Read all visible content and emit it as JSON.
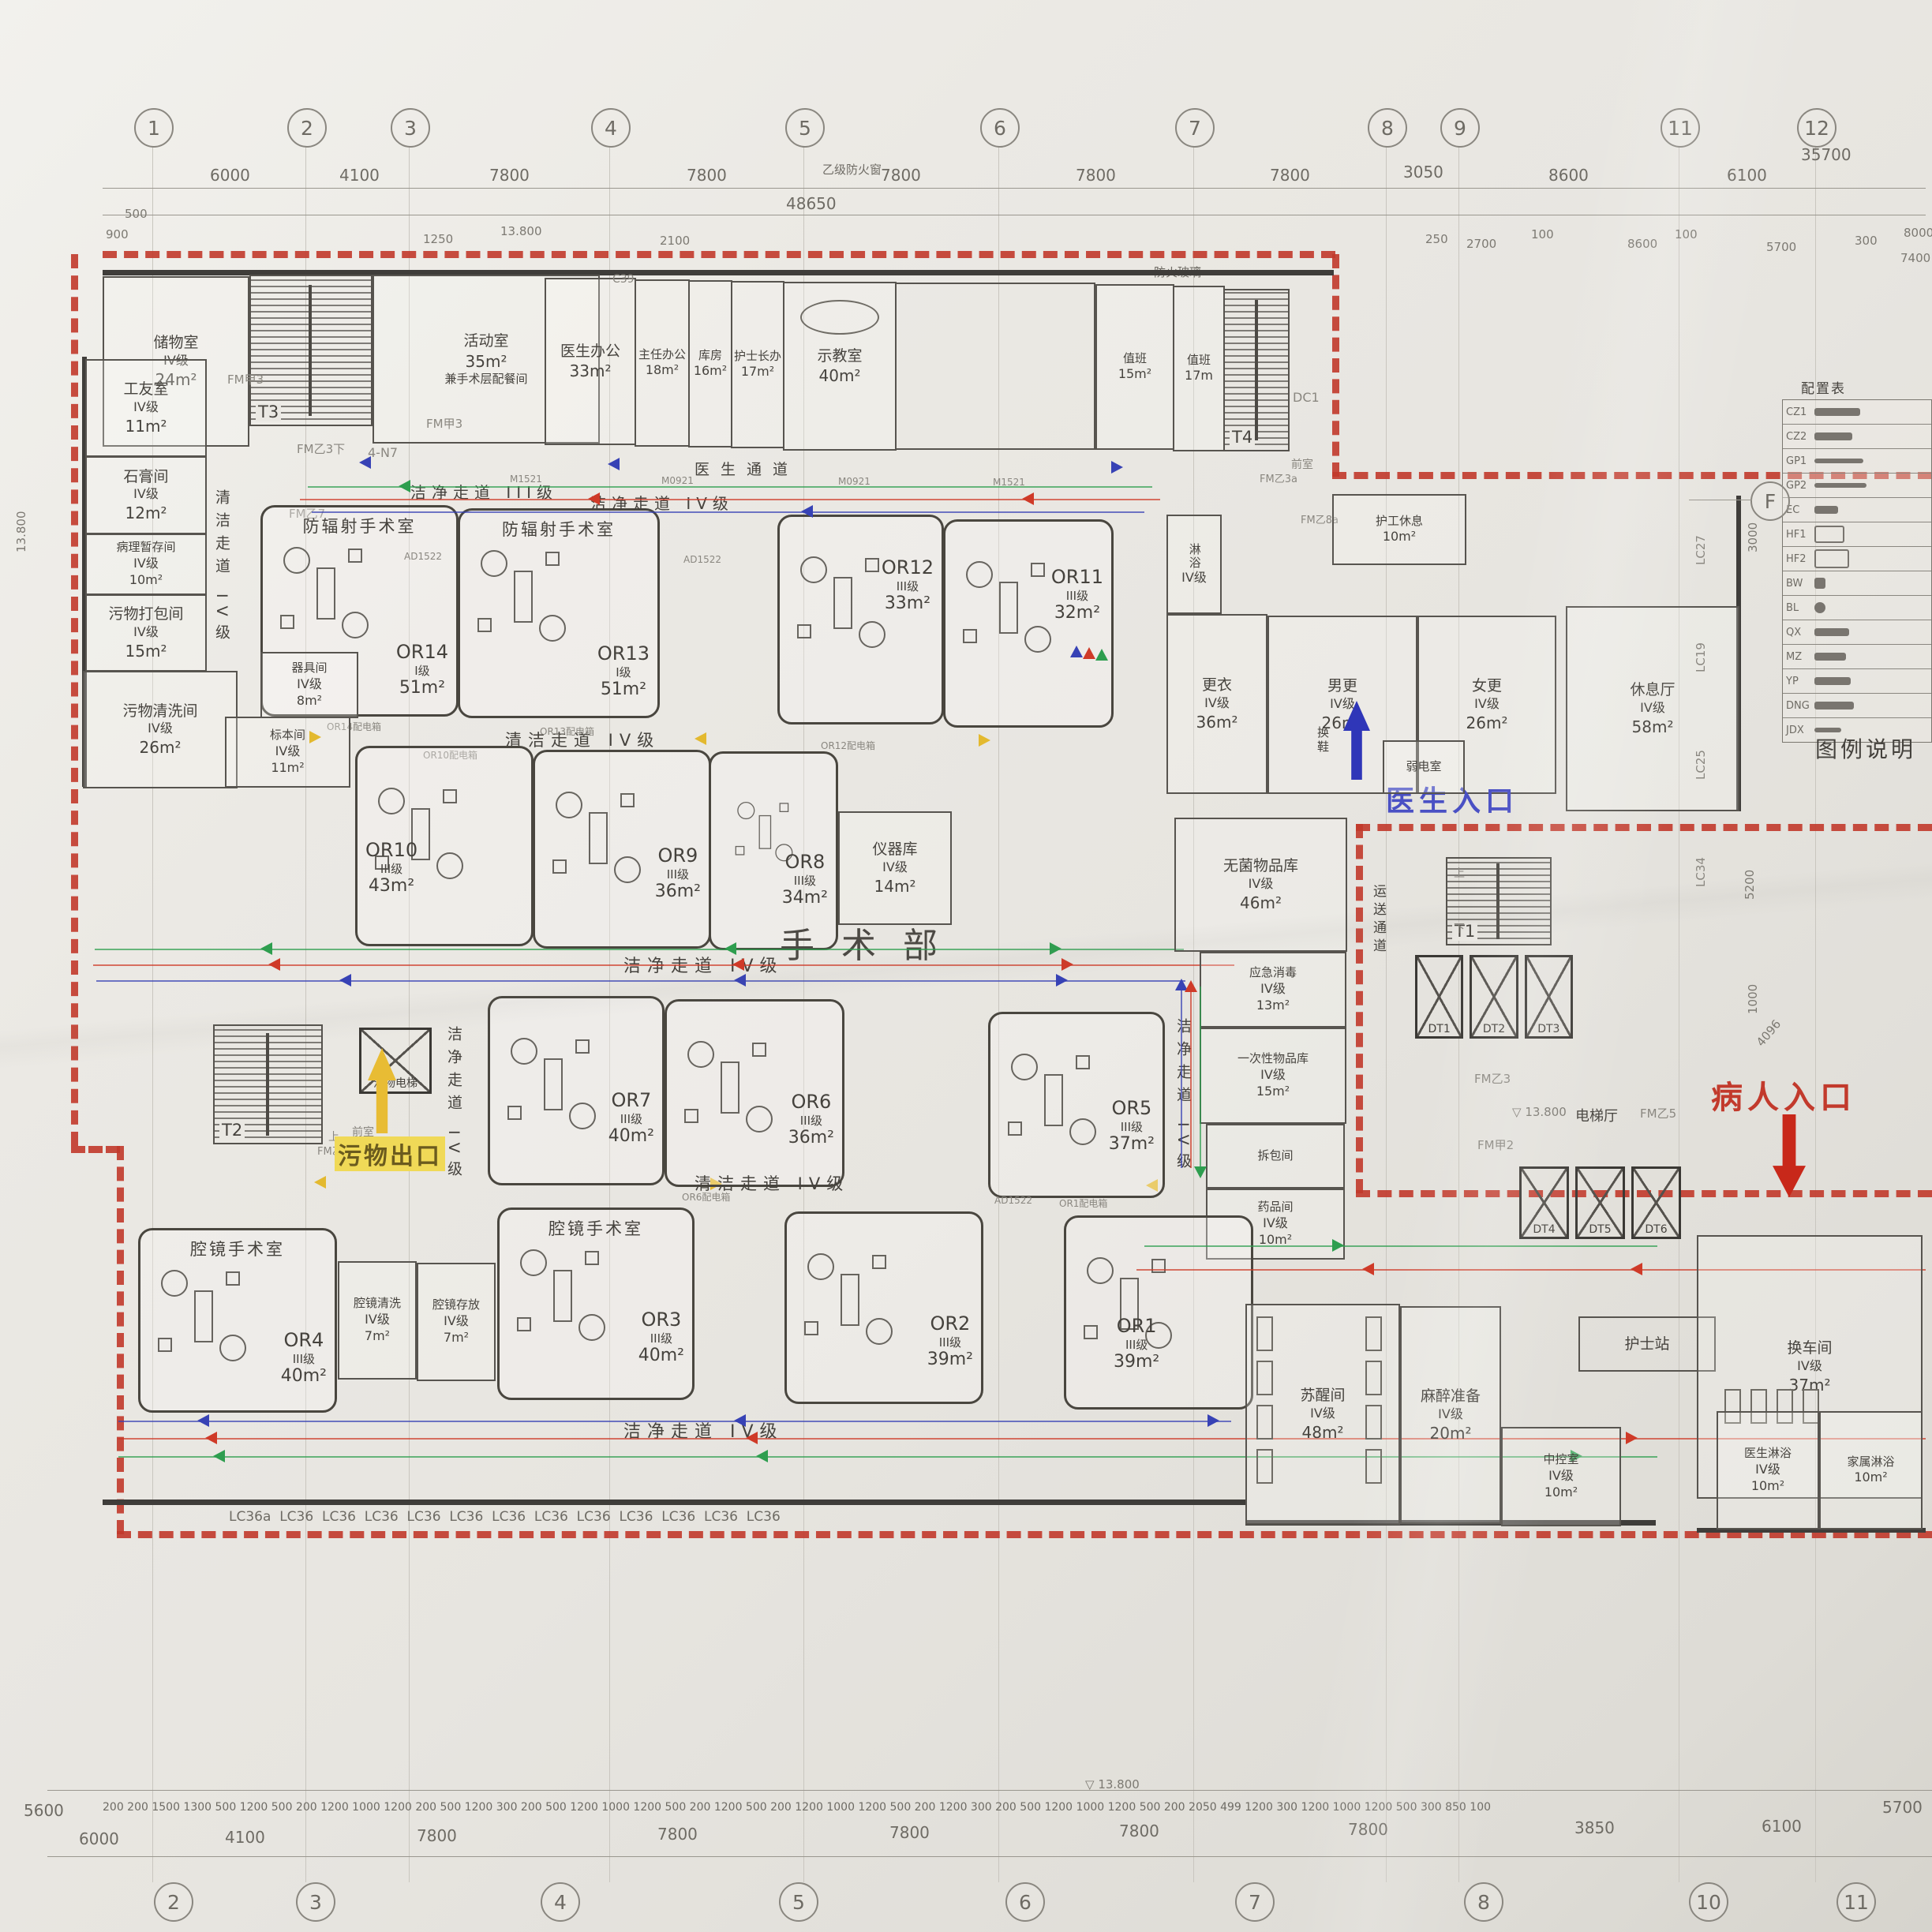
{
  "sheet": {
    "dept_label": "手术部",
    "legend_caption": "图例说明",
    "config_table_title": "配置表",
    "level": "13.800",
    "notes": {
      "fire_window": "乙级防火窗",
      "fire_glass": "防火玻璃"
    }
  },
  "grid": {
    "top_bubbles": [
      "1",
      "2",
      "3",
      "4",
      "5",
      "6",
      "7",
      "8",
      "9",
      "11",
      "12"
    ],
    "bottom_bubbles": [
      "2",
      "3",
      "4",
      "5",
      "6",
      "7",
      "8",
      "10",
      "11"
    ],
    "side_bubble": "F",
    "top_dims": [
      "6000",
      "4100",
      "7800",
      "7800",
      "7800",
      "7800",
      "7800",
      "3050",
      "8600",
      "6100"
    ],
    "top_overall": "48650",
    "top_right_overall": "35700",
    "sub": {
      "a": "900",
      "b": "500",
      "c": "1250",
      "d": "13.800",
      "e": "250",
      "f": "2700",
      "g": "100",
      "h": "8600",
      "i": "100",
      "j": "5700",
      "k": "300",
      "l": "8000",
      "m": "7400",
      "n": "2100"
    },
    "bottom_dims": [
      "6000",
      "4100",
      "7800",
      "7800",
      "7800",
      "7800",
      "7800",
      "3850",
      "6100"
    ],
    "bottom_left": "5600",
    "bottom_right": "5700",
    "bottom_level": "13.800",
    "bottom_small": [
      "200",
      "200",
      "1500",
      "1300",
      "500",
      "1200",
      "500",
      "200",
      "1200",
      "1000",
      "1200",
      "200",
      "500",
      "1200",
      "300",
      "200",
      "500",
      "1200",
      "1000",
      "1200",
      "500",
      "200",
      "1200",
      "500",
      "200",
      "1200",
      "1000",
      "1200",
      "500",
      "200",
      "1200",
      "300",
      "200",
      "500",
      "1200",
      "1000",
      "1200",
      "500",
      "200",
      "2050",
      "499",
      "1200",
      "300",
      "1200",
      "1000",
      "1200",
      "500",
      "300",
      "850",
      "100"
    ],
    "right_dims": {
      "a": "3000",
      "b": "5200",
      "c": "1000",
      "d": "4096"
    },
    "left_dim": "13.800"
  },
  "entrances": {
    "doctor": "医生入口",
    "patient": "病人入口",
    "waste": "污物出口"
  },
  "corridors": {
    "clean3": "洁净走道 III级",
    "clean4": "洁净走道 IV级",
    "cleaning4": "清洁走道 IV级",
    "doctor": "医生通道",
    "transport": "运送通道",
    "anteroom": "前室",
    "shoe": "换鞋"
  },
  "labels": {
    "radiation_or": "防辐射手术室",
    "endoscope_or": "腔镜手术室",
    "waste_lift": "污物电梯",
    "lift_hall": "电梯厅"
  },
  "ors": {
    "or1": {
      "code": "OR1",
      "grade": "III级",
      "area": "39m²"
    },
    "or2": {
      "code": "OR2",
      "grade": "III级",
      "area": "39m²"
    },
    "or3": {
      "code": "OR3",
      "grade": "III级",
      "area": "40m²"
    },
    "or4": {
      "code": "OR4",
      "grade": "III级",
      "area": "40m²"
    },
    "or5": {
      "code": "OR5",
      "grade": "III级",
      "area": "37m²"
    },
    "or6": {
      "code": "OR6",
      "grade": "III级",
      "area": "36m²"
    },
    "or7": {
      "code": "OR7",
      "grade": "III级",
      "area": "40m²"
    },
    "or8": {
      "code": "OR8",
      "grade": "III级",
      "area": "34m²"
    },
    "or9": {
      "code": "OR9",
      "grade": "III级",
      "area": "36m²"
    },
    "or10": {
      "code": "OR10",
      "grade": "III级",
      "area": "43m²"
    },
    "or11": {
      "code": "OR11",
      "grade": "III级",
      "area": "32m²"
    },
    "or12": {
      "code": "OR12",
      "grade": "III级",
      "area": "33m²"
    },
    "or13": {
      "code": "OR13",
      "grade": "I级",
      "area": "51m²"
    },
    "or14": {
      "code": "OR14",
      "grade": "I级",
      "area": "51m²"
    }
  },
  "rooms": {
    "storage24": {
      "name": "储物室",
      "grade": "IV级",
      "area": "24m²"
    },
    "activity": {
      "name": "活动室",
      "grade": "",
      "area": "35m²",
      "sub": "兼手术层配餐间"
    },
    "doc_office": {
      "name": "医生办公",
      "grade": "",
      "area": "33m²"
    },
    "chief_office": {
      "name": "主任办公",
      "grade": "",
      "area": "18m²"
    },
    "storeroom": {
      "name": "库房",
      "grade": "",
      "area": "16m²"
    },
    "head_nurse": {
      "name": "护士长办",
      "grade": "",
      "area": "17m²"
    },
    "demo": {
      "name": "示教室",
      "grade": "",
      "area": "40m²"
    },
    "duty15": {
      "name": "值班",
      "grade": "",
      "area": "15m²"
    },
    "duty17": {
      "name": "值班",
      "grade": "",
      "area": "17m"
    },
    "porter": {
      "name": "护工休息",
      "grade": "",
      "area": "10m²"
    },
    "worker": {
      "name": "工友室",
      "grade": "IV级",
      "area": "11m²"
    },
    "plaster": {
      "name": "石膏间",
      "grade": "IV级",
      "area": "12m²"
    },
    "pathology": {
      "name": "病理暂存间",
      "grade": "IV级",
      "area": "10m²"
    },
    "waste_pack": {
      "name": "污物打包间",
      "grade": "IV级",
      "area": "15m²"
    },
    "waste_wash": {
      "name": "污物清洗间",
      "grade": "IV级",
      "area": "26m²"
    },
    "utensil": {
      "name": "器具间",
      "grade": "IV级",
      "area": "8m²"
    },
    "specimen": {
      "name": "标本间",
      "grade": "IV级",
      "area": "11m²"
    },
    "instrument": {
      "name": "仪器库",
      "grade": "IV级",
      "area": "14m²"
    },
    "sterile": {
      "name": "无菌物品库",
      "grade": "IV级",
      "area": "46m²"
    },
    "emerg": {
      "name": "应急消毒",
      "grade": "IV级",
      "area": "13m²"
    },
    "disposable": {
      "name": "一次性物品库",
      "grade": "IV级",
      "area": "15m²"
    },
    "unpack": {
      "name": "拆包间",
      "grade": "",
      "area": ""
    },
    "medicine": {
      "name": "药品间",
      "grade": "IV级",
      "area": "10m²"
    },
    "shower": {
      "name": "淋浴",
      "grade": "IV级",
      "area": ""
    },
    "changing": {
      "name": "更衣",
      "grade": "IV级",
      "area": "36m²"
    },
    "male_change": {
      "name": "男更",
      "grade": "IV级",
      "area": "26m²"
    },
    "female_change": {
      "name": "女更",
      "grade": "IV级",
      "area": "26m²"
    },
    "lounge": {
      "name": "休息厅",
      "grade": "IV级",
      "area": "58m²"
    },
    "endo_wash": {
      "name": "腔镜清洗",
      "grade": "IV级",
      "area": "7m²"
    },
    "endo_store": {
      "name": "腔镜存放",
      "grade": "IV级",
      "area": "7m²"
    },
    "recovery": {
      "name": "苏醒间",
      "grade": "IV级",
      "area": "48m²"
    },
    "anesthesia": {
      "name": "麻醉准备",
      "grade": "IV级",
      "area": "20m²"
    },
    "nurse_station": {
      "name": "护士站",
      "grade": "",
      "area": ""
    },
    "control": {
      "name": "中控室",
      "grade": "IV级",
      "area": "10m²"
    },
    "bed_change": {
      "name": "换车间",
      "grade": "IV级",
      "area": "37m²"
    },
    "doc_shower": {
      "name": "医生淋浴",
      "grade": "IV级",
      "area": "10m²"
    },
    "family_shower": {
      "name": "家属淋浴",
      "grade": "",
      "area": "10m²"
    },
    "weak_power": {
      "name": "弱电室",
      "grade": "",
      "area": ""
    }
  },
  "stairs": {
    "t1": "T1",
    "t2": "T2",
    "t3": "T3",
    "t4": "T4",
    "up": "上",
    "down": "下"
  },
  "lifts": {
    "service": [
      "DT1",
      "DT2",
      "DT3"
    ],
    "patient": [
      "DT4",
      "DT5",
      "DT6"
    ]
  },
  "doors": {
    "fmj2": "FM甲2",
    "fmj3": "FM甲3",
    "fmy3": "FM乙3",
    "fmy3x": "FM乙3下",
    "fmy3a": "FM乙3a",
    "fmy5": "FM乙5",
    "fmy7": "FM乙7",
    "fmy8a": "FM乙8a",
    "dc1": "DC1",
    "n7": "4-N7",
    "c39": "C39"
  },
  "windows": {
    "bottom_row": [
      "LC36a",
      "LC36",
      "LC36",
      "LC36",
      "LC36",
      "LC36",
      "LC36",
      "LC36",
      "LC36",
      "LC36",
      "LC36",
      "LC36",
      "LC36"
    ],
    "right": {
      "a": "LC27",
      "b": "LC19",
      "c": "LC25",
      "d": "LC34"
    }
  },
  "equip_codes": {
    "ad": "AD1522",
    "m1": "M1521",
    "m2": "M0921",
    "db14": "OR14配电箱",
    "db13": "OR13配电箱",
    "db10": "OR10配电箱",
    "db12": "OR12配电箱",
    "db6": "OR6配电箱",
    "db1": "OR1配电箱"
  },
  "legend_codes": [
    "CZ1",
    "CZ2",
    "GP1",
    "GP2",
    "EC",
    "HF1",
    "HF2",
    "BW",
    "BL",
    "QX",
    "MZ",
    "YP",
    "DNG",
    "JDX"
  ]
}
